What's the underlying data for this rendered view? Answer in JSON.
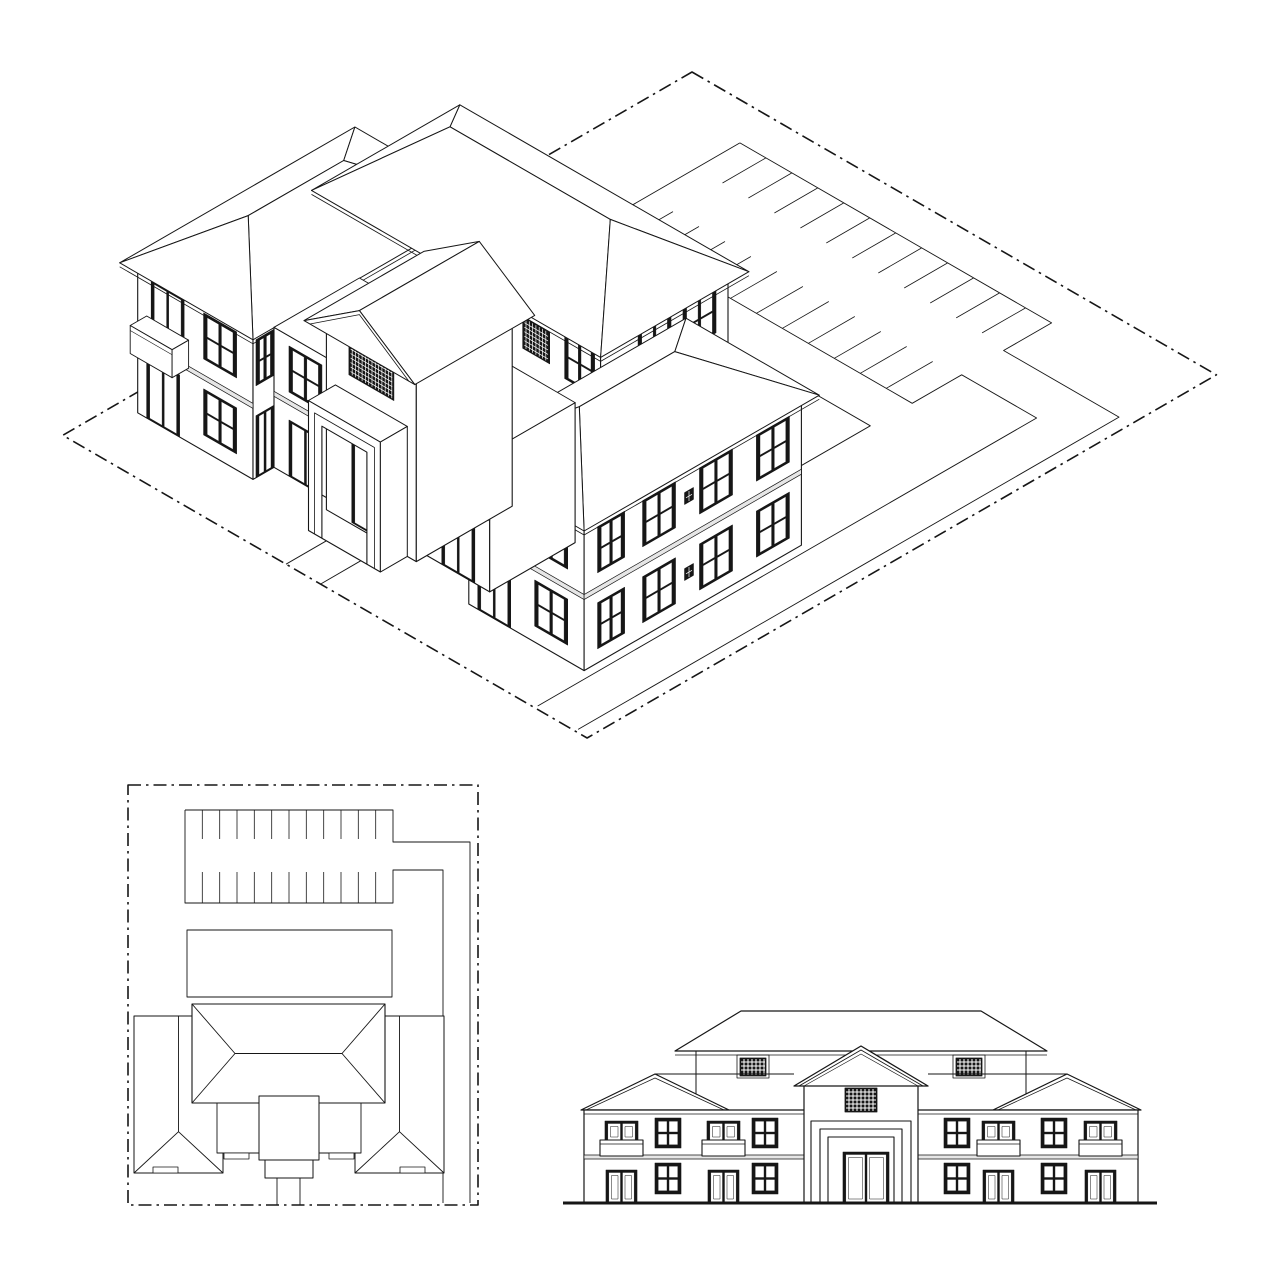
{
  "canvas": {
    "w": 1278,
    "h": 1278,
    "bg": "#ffffff",
    "ink": "#161616",
    "band_fill": "#e6e6e6",
    "boundary_dash": "13 5 2.5 5"
  },
  "views": {
    "isometric": {
      "name": "isometric-site-view"
    },
    "site_plan": {
      "name": "site-plan-view"
    },
    "elevation": {
      "name": "front-elevation-view"
    }
  },
  "iso": {
    "origin": {
      "x": 692,
      "y": 72
    },
    "scale": 1.73,
    "cos": 0.866,
    "sin": 0.5
  },
  "plan": {
    "origin": {
      "x": 128,
      "y": 785
    }
  },
  "site": {
    "w": 350,
    "h": 420
  },
  "parking": {
    "stalls_per_row": 12,
    "stripe_count": 11,
    "x1": 57,
    "x2": 265,
    "top_row": {
      "y1": 25,
      "y2": 54
    },
    "bottom_row": {
      "y1": 87,
      "y2": 118
    },
    "outlineA": [
      [
        57,
        25
      ],
      [
        265,
        25
      ],
      [
        265,
        57
      ],
      [
        342,
        57
      ],
      [
        342,
        418
      ]
    ],
    "outlineB": [
      [
        57,
        25
      ],
      [
        57,
        118
      ],
      [
        265,
        118
      ],
      [
        265,
        85
      ],
      [
        315,
        85
      ],
      [
        315,
        418
      ]
    ]
  },
  "lawn": {
    "x1": 59,
    "y1": 145,
    "x2": 264,
    "y2": 212
  },
  "walk": {
    "x1": 149,
    "x2": 172,
    "y1": 393,
    "y2": 420
  },
  "building": {
    "band": {
      "z1": 71,
      "z2": 76
    },
    "central": {
      "wall": [
        71,
        226,
        250,
        311
      ],
      "h": 212,
      "roof": {
        "rect": [
          64,
          219,
          257,
          318
        ],
        "ze": 212,
        "ridge": {
          "x1": 107,
          "x2": 214,
          "y": 268.5,
          "z": 270
        }
      },
      "south_wins": [
        [
          76,
          96,
          158,
          204
        ],
        [
          226,
          246,
          158,
          204
        ]
      ],
      "south_grilles": [
        [
          104,
          122,
          164,
          196
        ],
        [
          198,
          216,
          164,
          196
        ]
      ],
      "east_wins": [
        [
          234,
          256,
          158,
          204
        ],
        [
          264,
          286,
          158,
          204
        ]
      ]
    },
    "west_wing": {
      "wall": [
        12,
        237,
        89,
        382
      ],
      "h": 150,
      "roof": {
        "rect": [
          6,
          231,
          95,
          388
        ],
        "ze": 150,
        "ridge": {
          "x": 50.5,
          "y1": 283,
          "y2": 346.7,
          "z": 200
        }
      },
      "south_doors": [
        [
          18,
          40,
          0,
          62
        ]
      ],
      "south_wins": [
        [
          56,
          78,
          16,
          62
        ],
        [
          56,
          78,
          92,
          138
        ]
      ],
      "balcony": {
        "x1": 18,
        "x2": 46,
        "door": [
          21,
          43,
          78,
          140
        ]
      },
      "east_strip": {
        "x": 89,
        "door": [
          368,
          380,
          0,
          62
        ],
        "win": [
          368,
          380,
          92,
          138
        ]
      }
    },
    "east_wing": {
      "wall": [
        233,
        237,
        310,
        382
      ],
      "h": 150,
      "roof": {
        "rect": [
          227,
          231,
          316,
          388
        ],
        "ze": 150,
        "ridge": {
          "x": 271.5,
          "y1": 283,
          "y2": 346.7,
          "z": 200
        }
      },
      "south_doors": [
        [
          239,
          261,
          0,
          62
        ]
      ],
      "south_wins": [
        [
          277,
          299,
          16,
          62
        ],
        [
          277,
          299,
          92,
          138
        ]
      ],
      "balcony": {
        "x1": 239,
        "x2": 267,
        "door": [
          242,
          264,
          78,
          140
        ]
      },
      "east_wins_y": [
        [
          245,
          267
        ],
        [
          283,
          305
        ],
        [
          321,
          343
        ],
        [
          355,
          373
        ]
      ],
      "east_win_z": {
        "fl1": [
          14,
          60
        ],
        "fl2": [
          90,
          136
        ]
      },
      "east_vents": [
        {
          "y": [
            309,
            315
          ],
          "z": [
            32,
            44
          ]
        },
        {
          "y": [
            309,
            315
          ],
          "z": [
            108,
            120
          ]
        }
      ]
    },
    "west_conn": {
      "wall": [
        89,
        311,
        131,
        368
      ],
      "h": 140,
      "door": [
        99,
        121,
        0,
        56
      ],
      "win": [
        99,
        121,
        84,
        130
      ]
    },
    "east_conn": {
      "wall": [
        191,
        311,
        233,
        368
      ],
      "h": 140,
      "door": [
        201,
        223,
        0,
        56
      ],
      "win": [
        201,
        223,
        84,
        130
      ]
    },
    "tower": {
      "wall": [
        131,
        311,
        191,
        375
      ],
      "h": 190,
      "grille": [
        146,
        176,
        148,
        180
      ],
      "roof": {
        "x1": 124,
        "x2": 198,
        "y1": 303,
        "y2": 383,
        "ze": 190,
        "ridge_x": 161,
        "z": 232
      }
    },
    "porch": {
      "box": [
        137,
        375,
        185,
        393
      ],
      "h": 130,
      "opening": {
        "x1": 146,
        "x2": 176,
        "z": 112
      },
      "door": [
        148,
        174,
        2,
        106
      ]
    },
    "bumps": [
      [
        25,
        382,
        50,
        388
      ],
      [
        272,
        382,
        297,
        388
      ],
      [
        96,
        368,
        121,
        374
      ],
      [
        201,
        368,
        226,
        374
      ]
    ]
  },
  "elevation": {
    "ground": {
      "x1": 563,
      "x2": 1157,
      "y": 1203,
      "w": 3
    },
    "facade": {
      "x1": 584,
      "x2": 1138,
      "y1": 1110,
      "y2": 1203
    },
    "band": {
      "y1": 1155,
      "y2": 1159
    },
    "wing_eave_y": 1110,
    "wing_apex_y": 1074,
    "wing_roofs": [
      {
        "e1": 581,
        "e2": 729,
        "apex": 655
      },
      {
        "e1": 993,
        "e2": 1141,
        "apex": 1067
      }
    ],
    "conn_ridge": [
      [
        655,
        794
      ],
      [
        928,
        1067
      ]
    ],
    "upper": {
      "wx1": 696,
      "wx2": 1026,
      "ey": 1051,
      "ex1": 675,
      "ex2": 1047,
      "rx1": 741,
      "rx2": 981,
      "ry": 1011
    },
    "dormers": [
      [
        740,
        1058,
        766,
        1076
      ],
      [
        956,
        1058,
        982,
        1076
      ]
    ],
    "tower": {
      "x1": 804,
      "x2": 918,
      "top": 1082,
      "eave_x1": 794,
      "eave_x2": 928,
      "eave_y": 1086,
      "apex_x": 861,
      "apex_y": 1046
    },
    "tower_grille": [
      845,
      1088,
      877,
      1112
    ],
    "portal_frames": [
      [
        811,
        1121,
        911,
        1203
      ],
      [
        820,
        1129,
        902,
        1203
      ],
      [
        828,
        1137,
        894,
        1203
      ]
    ],
    "entry_door": [
      843,
      1152,
      889,
      1203
    ],
    "upper_balconies": [
      [
        600,
        1140,
        643,
        1156
      ],
      [
        702,
        1140,
        745,
        1156
      ],
      [
        977,
        1140,
        1020,
        1156
      ],
      [
        1079,
        1140,
        1122,
        1156
      ]
    ],
    "upper_balcony_doors": [
      [
        605,
        1121,
        638,
        1141
      ],
      [
        707,
        1121,
        740,
        1141
      ],
      [
        982,
        1121,
        1015,
        1141
      ],
      [
        1084,
        1121,
        1117,
        1141
      ]
    ],
    "upper_windows": [
      [
        655,
        1118,
        681,
        1148
      ],
      [
        752,
        1118,
        778,
        1148
      ],
      [
        944,
        1118,
        970,
        1148
      ],
      [
        1041,
        1118,
        1067,
        1148
      ]
    ],
    "lower_doors": [
      [
        606,
        1170,
        637,
        1203
      ],
      [
        708,
        1170,
        739,
        1203
      ],
      [
        983,
        1170,
        1014,
        1203
      ],
      [
        1085,
        1170,
        1116,
        1203
      ]
    ],
    "lower_windows": [
      [
        655,
        1163,
        681,
        1194
      ],
      [
        752,
        1163,
        778,
        1194
      ],
      [
        944,
        1163,
        970,
        1194
      ],
      [
        1041,
        1163,
        1067,
        1194
      ]
    ]
  }
}
